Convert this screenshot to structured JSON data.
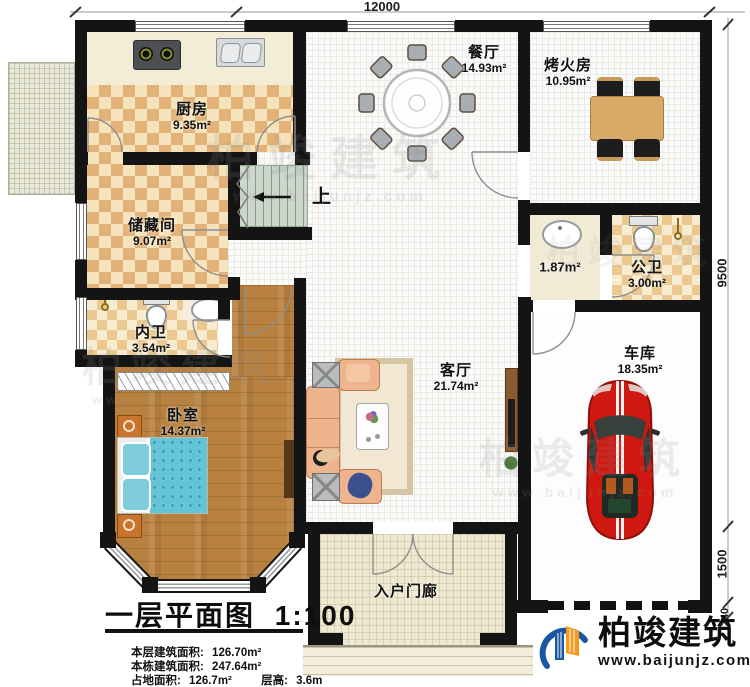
{
  "plan": {
    "dimensions": {
      "top": "12000",
      "side": [
        "9500",
        "1500",
        "240"
      ]
    },
    "stairs_up_label": "上",
    "rooms": [
      {
        "name": "厨房",
        "area": "9.35m²"
      },
      {
        "name": "餐厅",
        "area": "14.93m²"
      },
      {
        "name": "烤火房",
        "area": "10.95m²"
      },
      {
        "name": "储藏间",
        "area": "9.07m²"
      },
      {
        "name": "内卫",
        "area": "3.54m²"
      },
      {
        "name": "卧室",
        "area": "14.37m²"
      },
      {
        "name": "客厅",
        "area": "21.74m²"
      },
      {
        "name": "公卫",
        "area": "3.00m²"
      },
      {
        "name": "车库",
        "area": "18.35m²"
      },
      {
        "name": "入户门廊",
        "area": ""
      },
      {
        "name": "",
        "area": "1.87m²"
      }
    ],
    "title_block": {
      "title": "一层平面图",
      "scale": "1:100",
      "stats": [
        {
          "label": "本层建筑面积:",
          "value": "126.70m²"
        },
        {
          "label": "本栋建筑面积:",
          "value": "247.64m²"
        },
        {
          "label": "占地面积:",
          "value": "126.7m²"
        },
        {
          "label": "层高:",
          "value": "3.6m"
        }
      ]
    },
    "brand": {
      "name": "柏竣建筑",
      "url": "www.baijunjz.com"
    }
  }
}
